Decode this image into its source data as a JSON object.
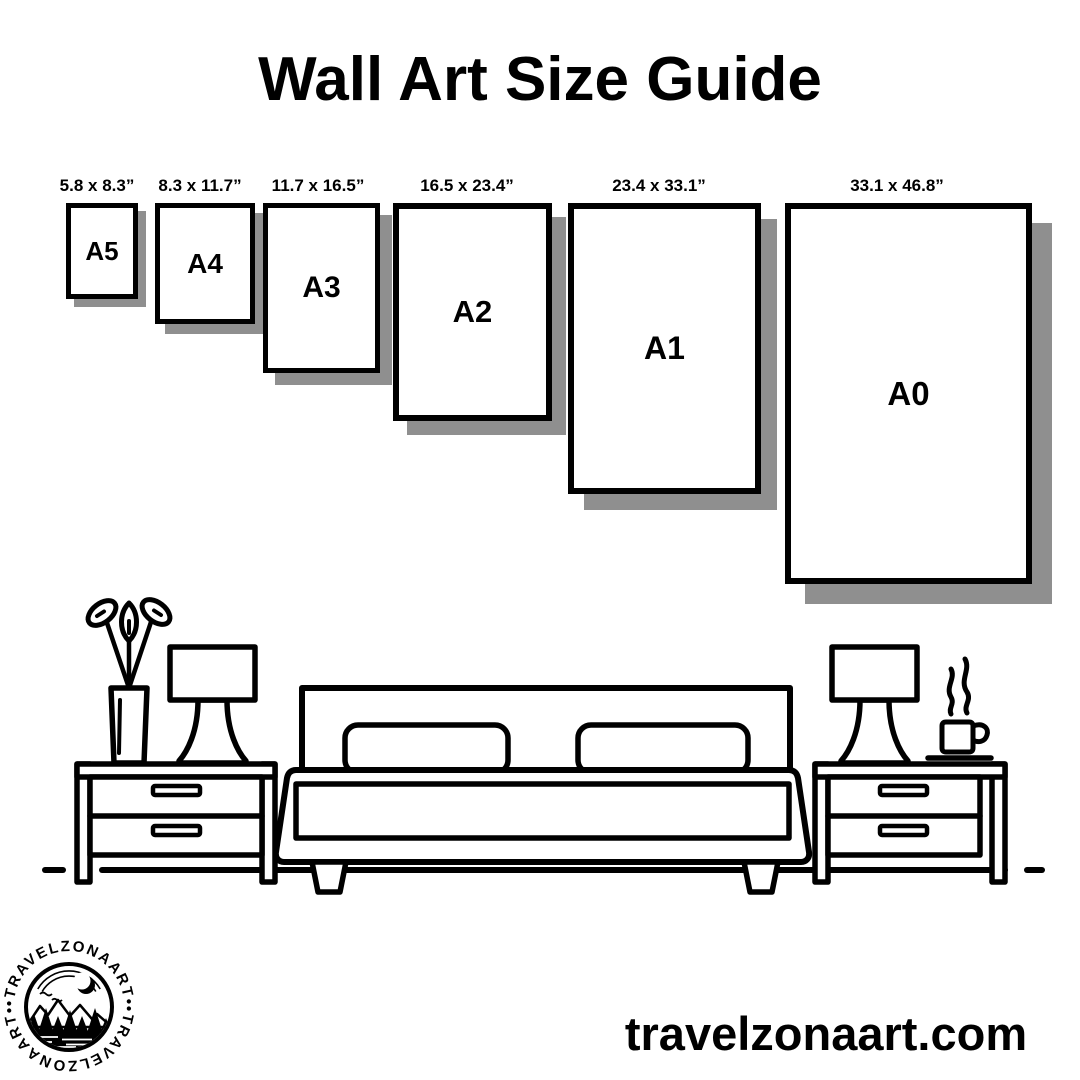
{
  "title": "Wall Art Size Guide",
  "sizes": [
    {
      "code": "A5",
      "dimensions": "5.8 x 8.3”"
    },
    {
      "code": "A4",
      "dimensions": "8.3 x 11.7”"
    },
    {
      "code": "A3",
      "dimensions": "11.7 x 16.5”"
    },
    {
      "code": "A2",
      "dimensions": "16.5 x 23.4”"
    },
    {
      "code": "A1",
      "dimensions": "23.4 x 33.1”"
    },
    {
      "code": "A0",
      "dimensions": "33.1 x 46.8”"
    }
  ],
  "illustration": {
    "description": "black and white line art of a bedroom: potted plant, table lamps, two nightstands with drawers, double bed with two pillows, steaming coffee cup"
  },
  "logo": {
    "brand": "TRAVELZONAART",
    "ring_text_top": "•TRAVELZONAART•",
    "ring_text_bottom": "•TRAVELZONAART•"
  },
  "footer": {
    "website": "travelzonaart.com"
  },
  "colors": {
    "ink": "#000000",
    "background": "#ffffff",
    "shadow": "#8f8f8f"
  }
}
